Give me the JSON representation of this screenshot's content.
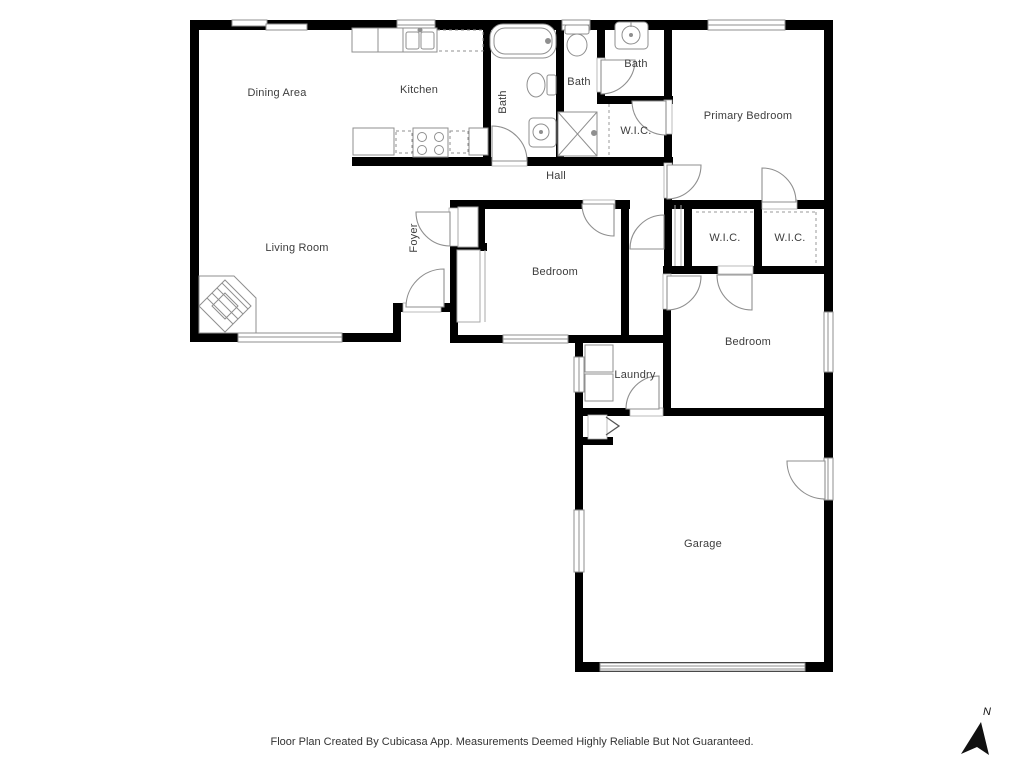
{
  "rooms": [
    {
      "key": "dining-area",
      "label": "Dining Area"
    },
    {
      "key": "kitchen",
      "label": "Kitchen"
    },
    {
      "key": "bath-left",
      "label": "Bath"
    },
    {
      "key": "bath-middle",
      "label": "Bath"
    },
    {
      "key": "bath-right",
      "label": "Bath"
    },
    {
      "key": "wic-top",
      "label": "W.I.C."
    },
    {
      "key": "primary-bedroom",
      "label": "Primary Bedroom"
    },
    {
      "key": "hall",
      "label": "Hall"
    },
    {
      "key": "living-room",
      "label": "Living Room"
    },
    {
      "key": "foyer",
      "label": "Foyer"
    },
    {
      "key": "bedroom-middle",
      "label": "Bedroom"
    },
    {
      "key": "wic-left",
      "label": "W.I.C."
    },
    {
      "key": "wic-right",
      "label": "W.I.C."
    },
    {
      "key": "bedroom-right",
      "label": "Bedroom"
    },
    {
      "key": "laundry",
      "label": "Laundry"
    },
    {
      "key": "garage",
      "label": "Garage"
    }
  ],
  "compass": {
    "label": "N"
  },
  "footer": {
    "text": "Floor Plan Created By Cubicasa App. Measurements Deemed Highly Reliable But Not Guaranteed."
  },
  "colors": {
    "wall": "#000000",
    "fixture_outline": "#8f8f8f",
    "label_text": "#3d3d3d",
    "background": "#ffffff"
  }
}
